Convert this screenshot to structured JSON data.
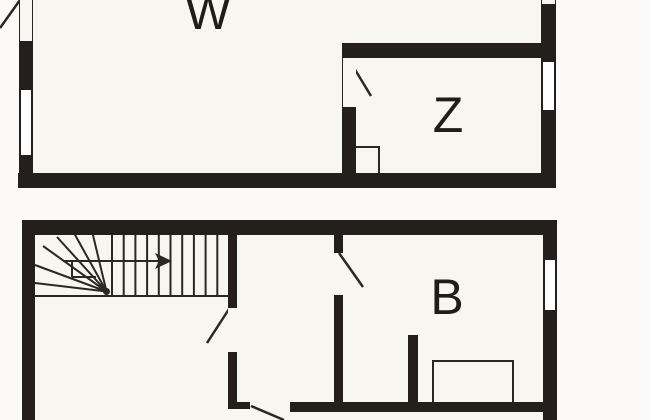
{
  "image": {
    "type": "architectural floor plan drawing",
    "floors_shown": 2,
    "note_top_plan_cut": "top floor plan is cropped at image top",
    "note_bottom_plan_cut": "bottom floor plan is cropped at image bottom"
  },
  "colors": {
    "wall": "#241f1c",
    "outside": "#fbfaf8",
    "floor": "#f8f6f1",
    "line": "#2b2724",
    "label": "#1f1c19",
    "window_fill": "#ffffff"
  },
  "floors": [
    {
      "name": "upper floor plan",
      "rooms": [
        {
          "label": "W"
        },
        {
          "label": "Z"
        }
      ],
      "features": [
        "door swing at top-left (cropped)",
        "window in left wall",
        "window in right wall",
        "small window at top of right wall (cropped)",
        "door from W into Z with swing",
        "flue niche in lower-left corner of Z"
      ]
    },
    {
      "name": "lower floor plan",
      "rooms": [
        {
          "label": "B"
        }
      ],
      "features": [
        "winder staircase with straight flight",
        "stair direction arrow pointing right",
        "door from hall to middle room",
        "door from middle room into B with swing",
        "door in lower wall (cropped at bottom)",
        "window in right wall",
        "wall stub in room B",
        "rectangular fixture against lower wall of B"
      ]
    }
  ],
  "icons": {
    "stair_direction_arrow": "right-arrow"
  }
}
